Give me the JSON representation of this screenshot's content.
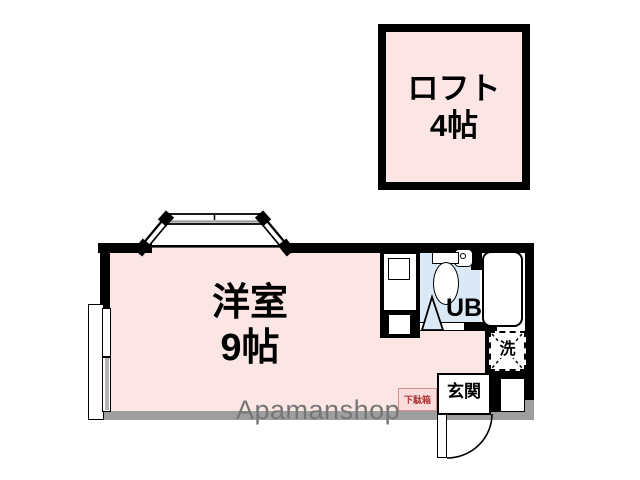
{
  "rooms": {
    "loft": {
      "name": "ロフト",
      "size": "4帖"
    },
    "western_room": {
      "name": "洋室",
      "size": "9帖"
    },
    "unit_bath": {
      "label": "UB"
    },
    "washer_space": {
      "label": "洗"
    },
    "entrance": {
      "label": "玄関"
    },
    "shoe_box": {
      "label": "下駄箱"
    }
  },
  "watermark": {
    "text": "Apamanshop"
  },
  "colors": {
    "room_fill": "#fbe5e5",
    "bath_fill": "#dbe9f6",
    "wall_black": "#000000",
    "wall_gray": "#9e9e9e",
    "shoe_box_border": "#d98f8f",
    "shoe_box_text": "#b03535",
    "watermark_text": "#767676"
  }
}
